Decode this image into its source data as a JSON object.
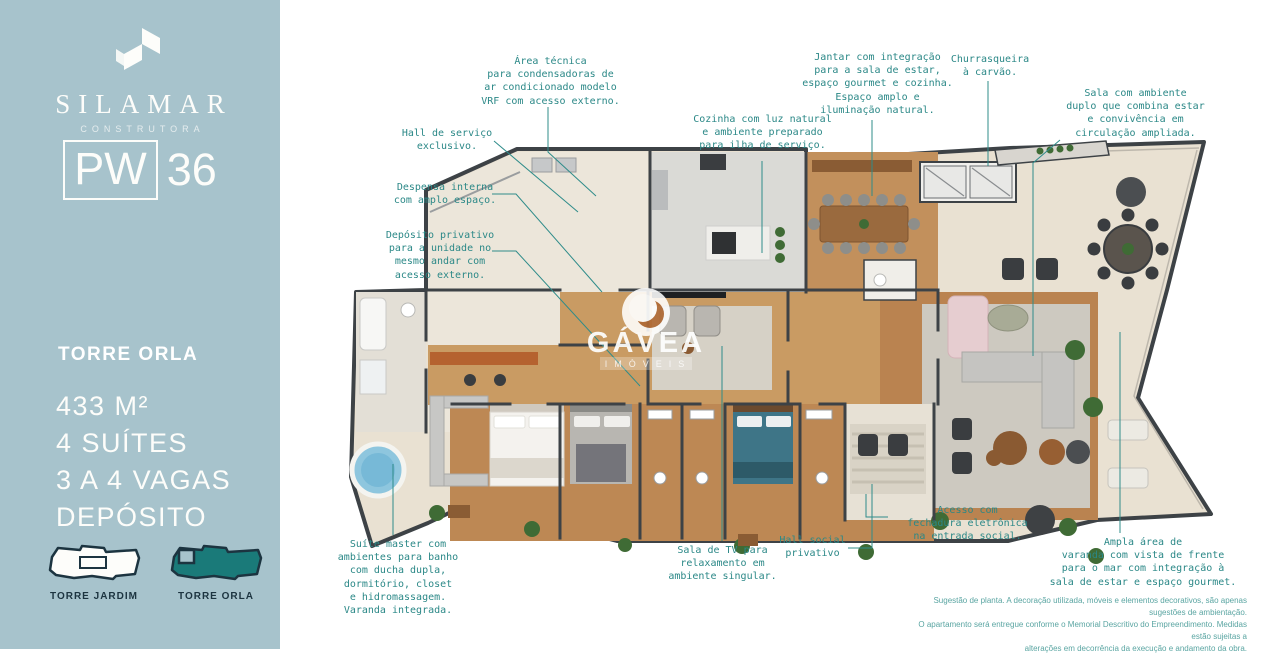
{
  "sidebar": {
    "brand": {
      "name": "SILAMAR",
      "subtitle": "CONSTRUTORA"
    },
    "unit": {
      "prefix": "PW",
      "number": "36"
    },
    "tower_title": "TORRE ORLA",
    "specs": [
      "433 M²",
      "4 SUÍTES",
      "3 A 4 VAGAS",
      "DEPÓSITO"
    ],
    "towers": [
      {
        "label": "TORRE JARDIM"
      },
      {
        "label": "TORRE ORLA"
      }
    ]
  },
  "watermark": {
    "name": "GÁVEA",
    "subtitle": "IMÓVEIS"
  },
  "annotations": {
    "area_tecnica": "Área técnica\npara condensadoras de\nar condicionado modelo\nVRF com acesso externo.",
    "hall_servico": "Hall de serviço\nexclusivo.",
    "despensa": "Despensa interna\ncom amplo espaço.",
    "deposito": "Depósito privativo\npara a unidade no\nmesmo andar com\nacesso externo.",
    "cozinha": "Cozinha com luz natural\ne ambiente preparado\npara ilha de serviço.",
    "jantar": "Jantar com integração\npara a sala de estar,\nespaço gourmet e cozinha.\nEspaço amplo e\niluminação natural.",
    "churrasqueira": "Churrasqueira\nà carvão.",
    "sala_duplo": "Sala com ambiente\nduplo que combina estar\ne convivência em\ncirculação ampliada.",
    "suite_master": "Suíte master com\nambientes para banho\ncom ducha dupla,\ndormitório, closet\ne hidromassagem.\nVaranda integrada.",
    "sala_tv": "Sala de TV para\nrelaxamento em\nambiente singular.",
    "hall_social": "Hall social\nprivativo",
    "acesso": "Acesso com\nfechadura eletrônica\nna entrada social.",
    "ampla_varanda": "Ampla área de\nvaranda com vista de frente\npara o mar com integração à\nsala de estar e espaço gourmet."
  },
  "disclaimer": "Sugestão de planta. A decoração utilizada, móveis e elementos decorativos, são apenas sugestões de ambientação.\nO apartamento será entregue conforme o Memorial Descritivo do Empreendimento. Medidas estão sujeitas a\nalterações em decorrência da execução e andamento da obra.",
  "colors": {
    "sidebar_bg": "#a7c3cc",
    "annotation_teal": "#2b8887",
    "tower_navy": "#1c3440",
    "tower_orla_fill": "#1a7a79",
    "wall": "#3d4246",
    "wood_floor": "#c08a56",
    "terrace_floor": "#e9e1d2"
  }
}
